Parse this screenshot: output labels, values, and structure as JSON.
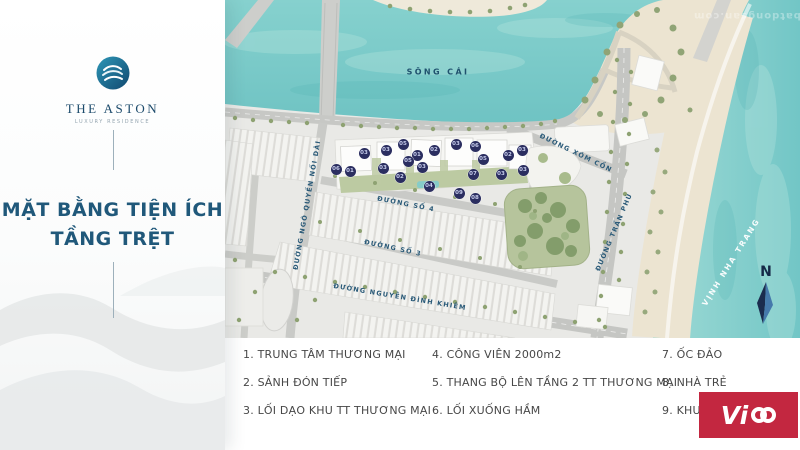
{
  "sidebar": {
    "brand": {
      "name": "THE ASTON",
      "tagline": "LUXURY RESIDENCE"
    },
    "title_line1": "MẶT BẰNG TIỆN ÍCH",
    "title_line2": "TẦNG TRỆT"
  },
  "map": {
    "labels": {
      "river": "SÔNG CÁI",
      "bay": "VỊNH NHA TRANG",
      "compass_north": "N",
      "street_xom_con": "ĐƯỜNG XÓM CỒN",
      "street_tran_phu": "ĐƯỜNG TRẦN PHÚ",
      "street_so_4": "ĐƯỜNG SỐ 4",
      "street_so_3": "ĐƯỜNG SỐ 3",
      "street_nguyen_dinh_khiem": "ĐƯỜNG NGUYỄN ĐÌNH KHIÊM",
      "street_ngo_quyen": "ĐƯỜNG NGÔ QUYỀN NỐI DÀI"
    },
    "markers": [
      {
        "label": "03",
        "x": 139,
        "y": 153
      },
      {
        "label": "03",
        "x": 161,
        "y": 150
      },
      {
        "label": "05",
        "x": 178,
        "y": 144
      },
      {
        "label": "01",
        "x": 192,
        "y": 155
      },
      {
        "label": "02",
        "x": 209,
        "y": 150
      },
      {
        "label": "03",
        "x": 231,
        "y": 144
      },
      {
        "label": "06",
        "x": 250,
        "y": 146
      },
      {
        "label": "05",
        "x": 258,
        "y": 159
      },
      {
        "label": "02",
        "x": 283,
        "y": 155
      },
      {
        "label": "03",
        "x": 297,
        "y": 150
      },
      {
        "label": "06",
        "x": 111,
        "y": 169
      },
      {
        "label": "01",
        "x": 125,
        "y": 171
      },
      {
        "label": "03",
        "x": 158,
        "y": 168
      },
      {
        "label": "05",
        "x": 183,
        "y": 161
      },
      {
        "label": "03",
        "x": 197,
        "y": 167
      },
      {
        "label": "02",
        "x": 175,
        "y": 177
      },
      {
        "label": "03",
        "x": 276,
        "y": 174
      },
      {
        "label": "03",
        "x": 298,
        "y": 170
      },
      {
        "label": "07",
        "x": 248,
        "y": 174
      },
      {
        "label": "04",
        "x": 204,
        "y": 186
      },
      {
        "label": "09",
        "x": 234,
        "y": 193
      },
      {
        "label": "08",
        "x": 250,
        "y": 198
      }
    ]
  },
  "legend": {
    "columns": [
      {
        "items": [
          "1. TRUNG TÂM THƯƠNG MẠI",
          "2. SẢNH ĐÓN TIẾP",
          "3. LỐI DẠO KHU TT THƯƠNG MẠI"
        ]
      },
      {
        "items": [
          "4. CÔNG VIÊN 2000m2",
          "5. THANG BỘ LÊN TẦNG 2 TT THƯƠNG MẠI",
          "6. LỐI XUỐNG HẦM"
        ]
      },
      {
        "items": [
          "7. ỐC ĐẢO",
          "8. NHÀ TRẺ",
          "9. KHU"
        ]
      }
    ]
  },
  "watermarks": {
    "logo_text": "Vi",
    "faint_text": "batdongsan.com"
  },
  "colors": {
    "accent": "#20587a",
    "water": "#74c6c5",
    "sand": "#ece4d1",
    "marker": "#2b2e60",
    "vico_red": "#c32740",
    "park_green": "#b6c49c"
  }
}
